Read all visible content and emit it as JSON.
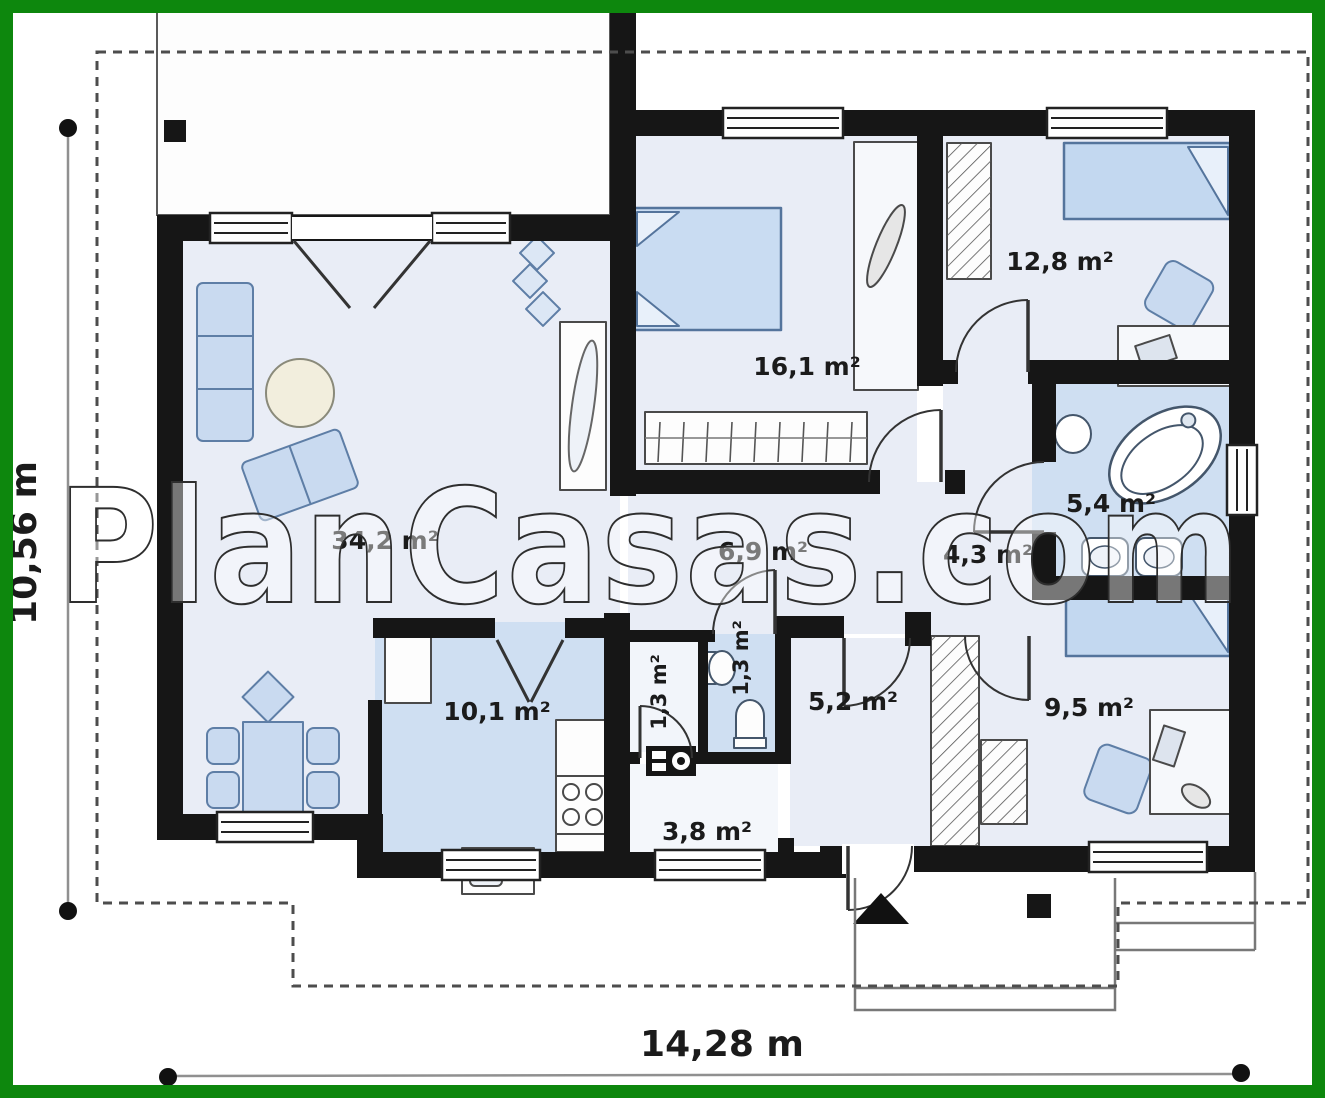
{
  "watermark": {
    "text": "PlanCasas.com"
  },
  "dimensions": {
    "width_label": "14,28 m",
    "height_label": "10,56 m"
  },
  "rooms": {
    "living": {
      "area": "34,2 m²"
    },
    "kitchen": {
      "area": "10,1 m²"
    },
    "bedroom_top": {
      "area": "16,1 m²"
    },
    "bedroom_right": {
      "area": "12,8 m²"
    },
    "bathroom": {
      "area": "5,4 m²"
    },
    "corridor": {
      "area": "6,9 m²"
    },
    "hall": {
      "area": "4,3 m²"
    },
    "wc_a": {
      "area": "1,3 m²"
    },
    "wc_b": {
      "area": "1,3 m²"
    },
    "hallway": {
      "area": "5,2 m²"
    },
    "bedroom_bottom": {
      "area": "9,5 m²"
    },
    "vestibule": {
      "area": "3,8 m²"
    }
  },
  "colors": {
    "frame_green": "#0d870d",
    "wall_black": "#161616",
    "room_light": "#e9edf6",
    "room_blue": "#cfdff2",
    "furniture_blue": "#c9daf0"
  }
}
